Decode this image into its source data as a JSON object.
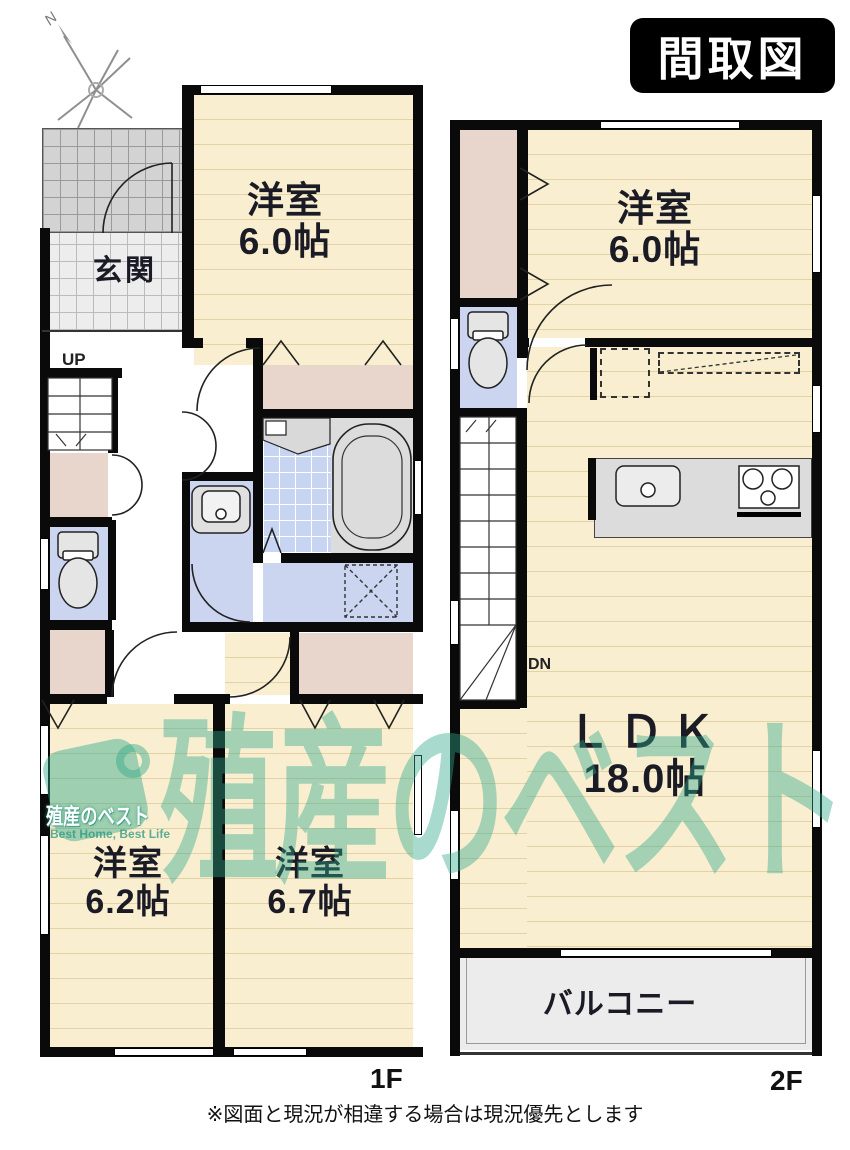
{
  "title": "間取図",
  "compass": {
    "north_label": "N"
  },
  "floor1": {
    "label": "1F",
    "entrance_label": "玄関",
    "stairs_label": "UP",
    "rooms": {
      "bedroom_top": {
        "name": "洋室",
        "size": "6.0帖"
      },
      "bedroom_left": {
        "name": "洋室",
        "size": "6.2帖"
      },
      "bedroom_right": {
        "name": "洋室",
        "size": "6.7帖"
      }
    }
  },
  "floor2": {
    "label": "2F",
    "stairs_label": "DN",
    "rooms": {
      "bedroom": {
        "name": "洋室",
        "size": "6.0帖"
      },
      "ldk": {
        "name": "ＬＤＫ",
        "size": "18.0帖"
      },
      "balcony": {
        "name": "バルコニー"
      }
    }
  },
  "watermark": {
    "logo_text": "殖産のベスト",
    "tagline": "Best Home, Best Life",
    "big_text": "殖産のベスト"
  },
  "disclaimer": "※図面と現況が相違する場合は現況優先とします",
  "colors": {
    "room_cream": "#F9EFD0",
    "closet_pink": "#E8D6CC",
    "wet_area_blue": "#CBD5F0",
    "watermark_teal": "#2FA88A",
    "wall_black": "#0A0A0A"
  }
}
